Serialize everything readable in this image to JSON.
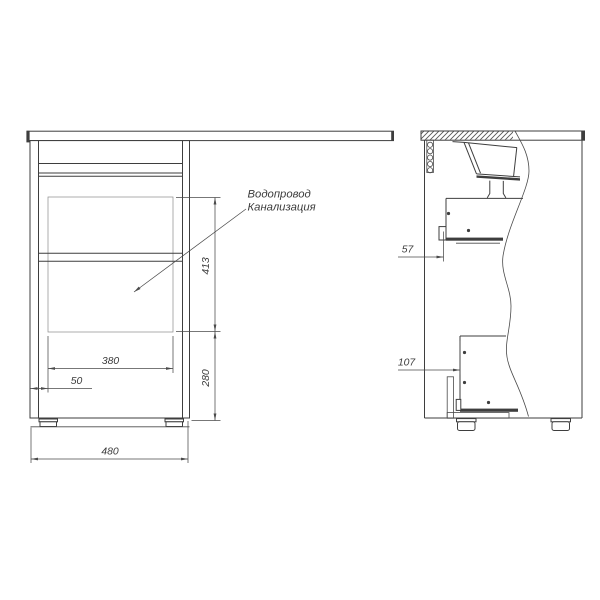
{
  "drawing": {
    "type": "furniture-installation-technical-drawing",
    "background": "#ffffff",
    "line_color": "#3e3e3e",
    "dimension_color": "#4a4a4a",
    "hatch_color": "#969696",
    "annotation": {
      "line1": "Водопровод",
      "line2": "Канализация"
    },
    "front_view": {
      "dim_cutout_height": "413",
      "dim_plinth_height": "280",
      "dim_cutout_width": "380",
      "dim_cutout_offset": "50",
      "dim_overall_width": "480"
    },
    "side_view": {
      "dim_upper_bracket_offset": "57",
      "dim_lower_bracket_offset": "107"
    }
  }
}
